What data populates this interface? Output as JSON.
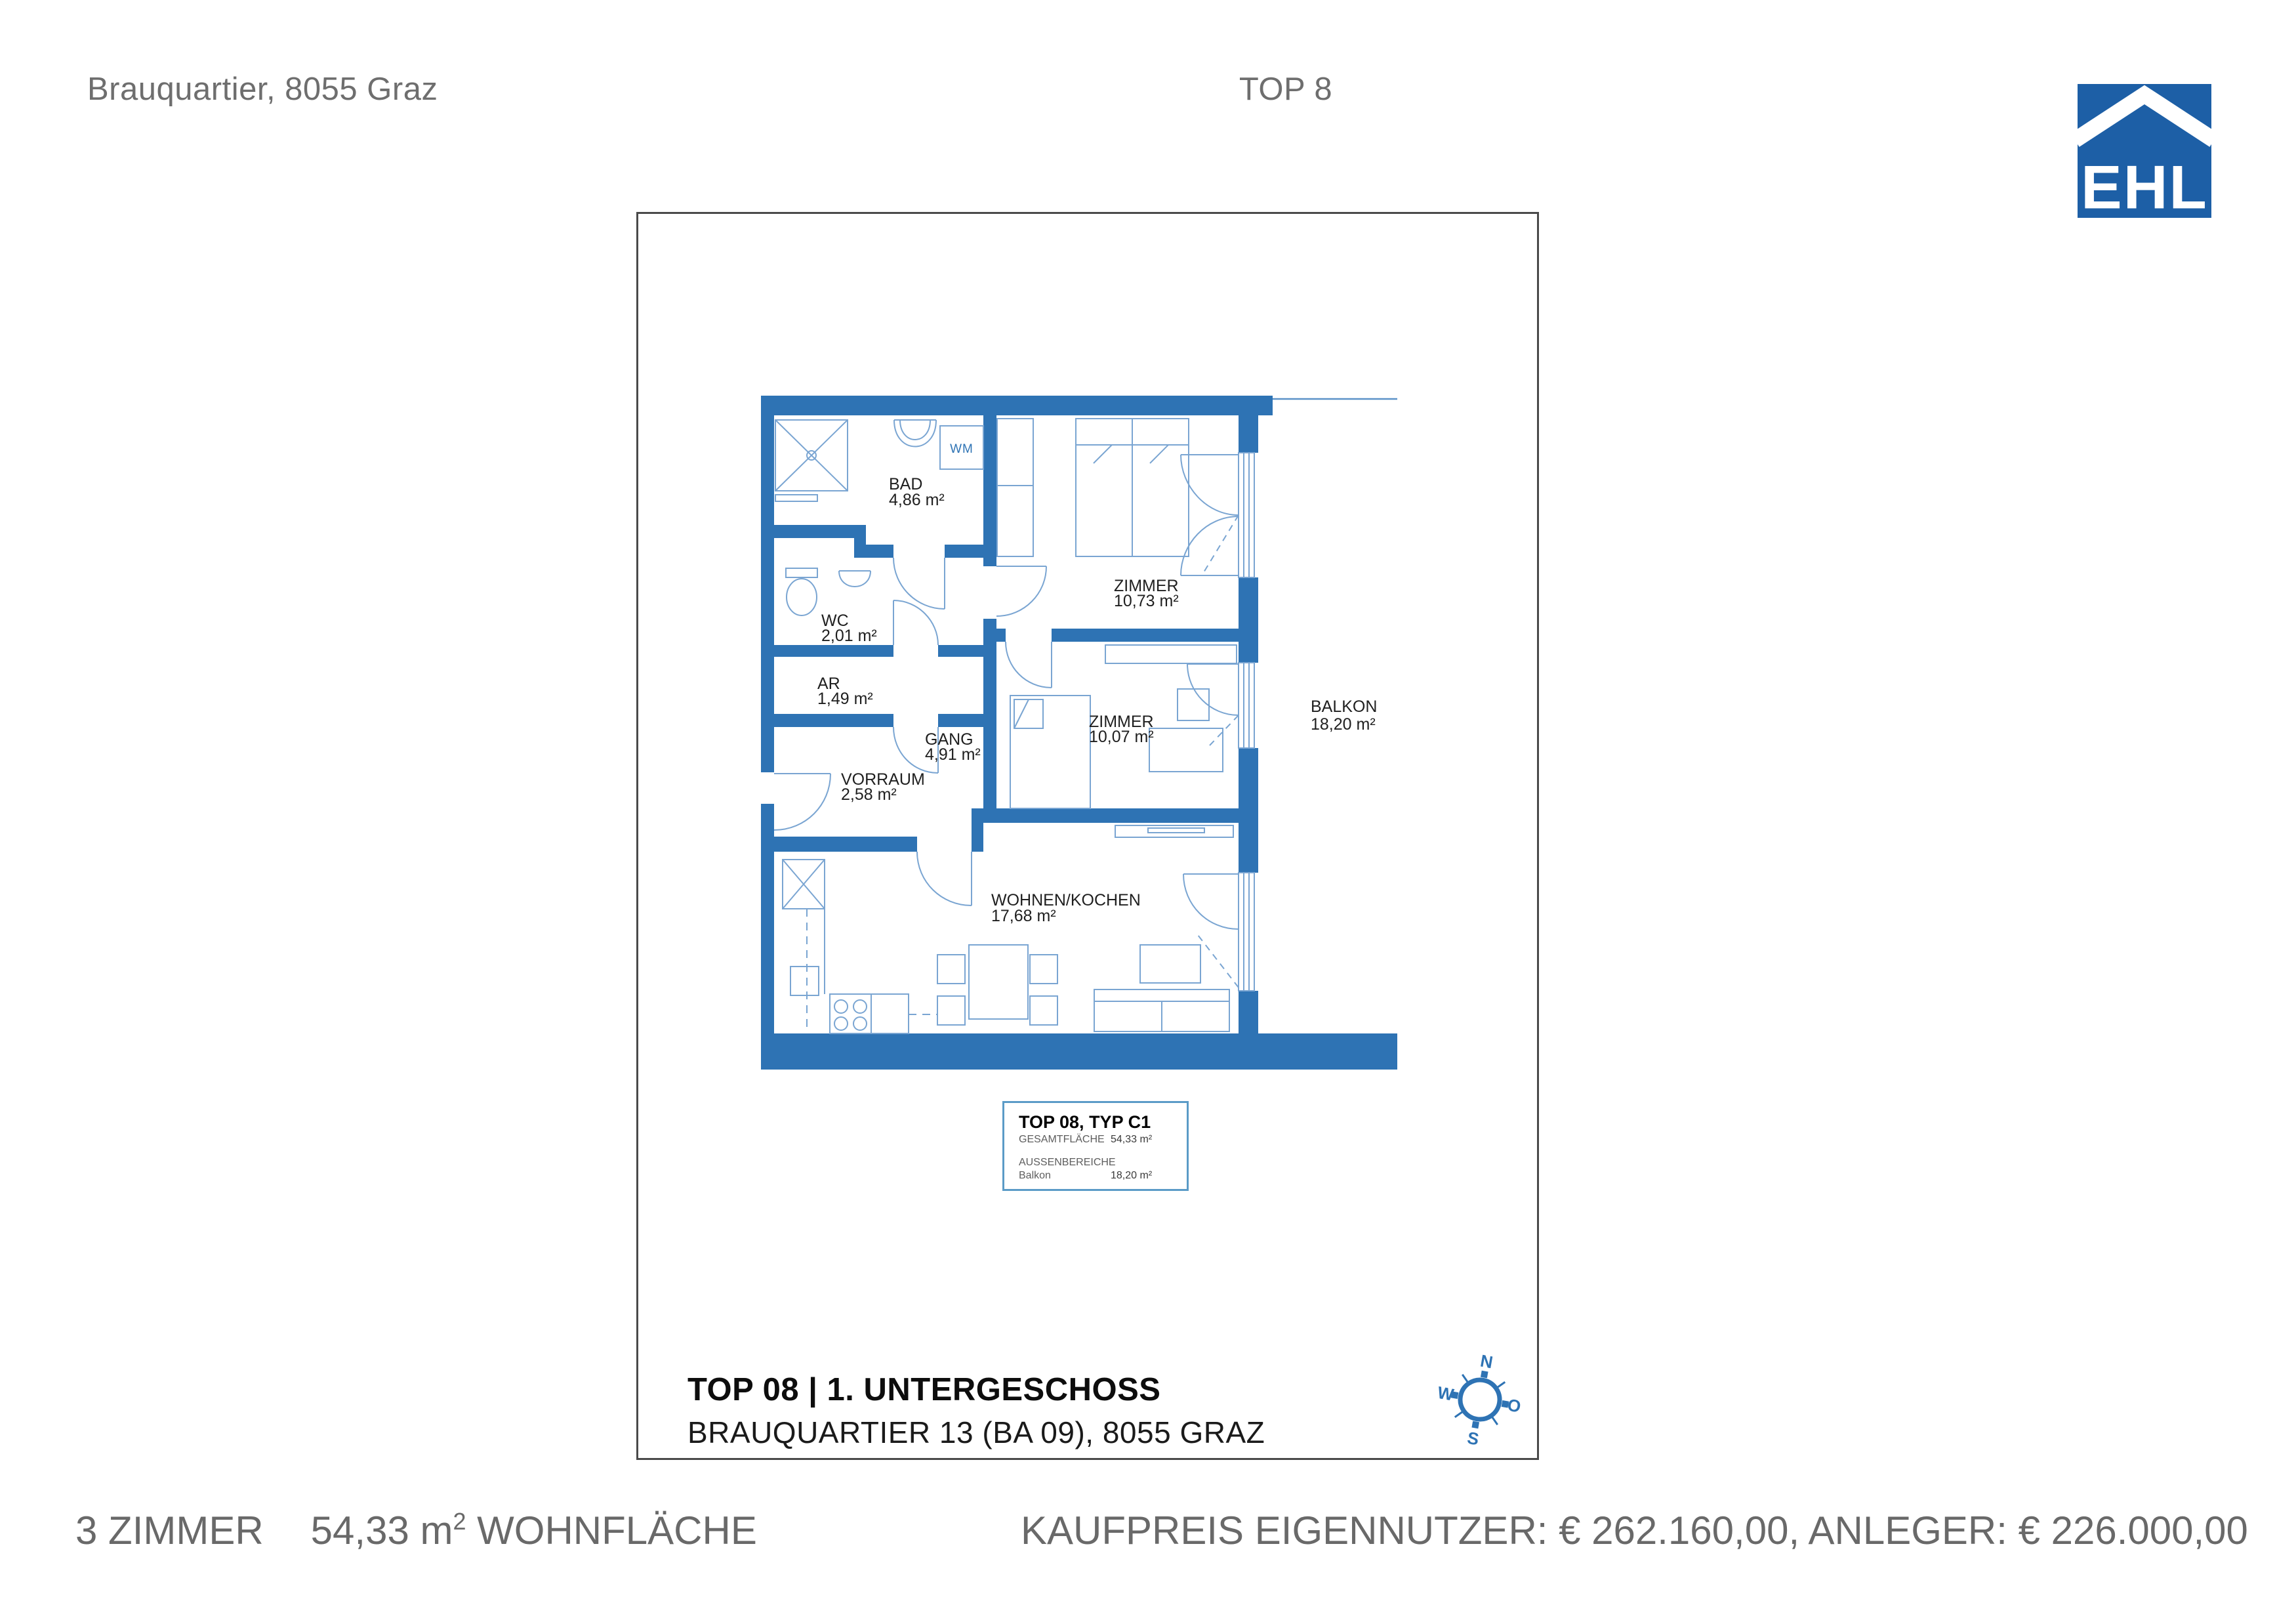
{
  "header": {
    "project": "Brauquartier, 8055 Graz",
    "unit": "TOP 8"
  },
  "logo": {
    "text": "EHL"
  },
  "plan": {
    "rooms": [
      {
        "name": "BAD",
        "area": "4,86 m²"
      },
      {
        "name": "WC",
        "area": "2,01 m²"
      },
      {
        "name": "AR",
        "area": "1,49 m²"
      },
      {
        "name": "GANG",
        "area": "4,91 m²"
      },
      {
        "name": "VORRAUM",
        "area": "2,58 m²"
      },
      {
        "name": "ZIMMER",
        "area": "10,73 m²"
      },
      {
        "name": "ZIMMER",
        "area": "10,07 m²"
      },
      {
        "name": "WOHNEN/KOCHEN",
        "area": "17,68 m²"
      },
      {
        "name": "BALKON",
        "area": "18,20 m²"
      }
    ],
    "labels": {
      "wm": "WM"
    }
  },
  "info_box": {
    "title": "TOP 08, TYP C1",
    "total_label": "GESAMTFLÄCHE",
    "total_value": "54,33 m²",
    "outdoor_label": "AUSSENBEREICHE",
    "outdoor_name": "Balkon",
    "outdoor_value": "18,20 m²"
  },
  "plan_footer": {
    "title": "TOP 08 | 1. UNTERGESCHOSS",
    "subtitle": "BRAUQUARTIER 13 (BA 09), 8055 GRAZ"
  },
  "compass": {
    "n": "N",
    "o": "O",
    "s": "S",
    "w": "W"
  },
  "footer": {
    "rooms": "3 ZIMMER",
    "area_value": "54,33 m",
    "area_sup": "2",
    "area_label": "WOHNFLÄCHE",
    "price": "KAUFPREIS EIGENNUTZER: € 262.160,00, ANLEGER: € 226.000,00"
  },
  "colors": {
    "wall_blue": "#2e73b4",
    "furniture_blue": "#7aa5d2",
    "logo_blue": "#1d5fa6",
    "text_gray": "#6e6e6e",
    "frame_gray": "#4a4a4a",
    "info_border_blue": "#5b9bc7"
  }
}
